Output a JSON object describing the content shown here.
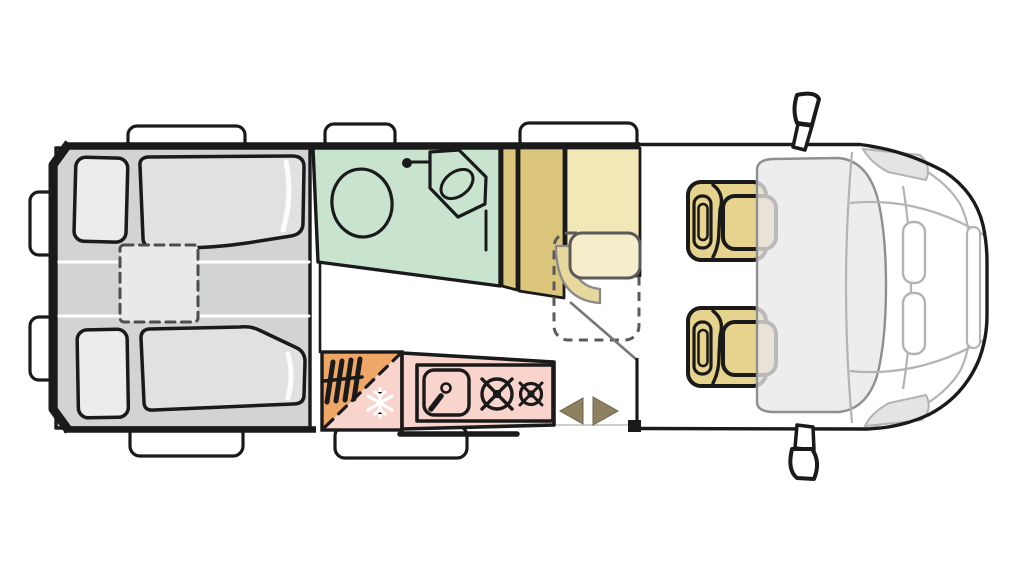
{
  "diagram": {
    "type": "campervan-floorplan-top-view",
    "orientation": "van front (cab) on the right, rear doors on the left",
    "areas": {
      "rear_beds": "two single beds with pillows and a dashed center filler cushion",
      "bathroom": "washroom with toilet and fold-away sink",
      "wardrobe": "tall wardrobe cabinets",
      "dinette": "travel seat with dashed removable table outline",
      "kitchen": "kitchen counter with sink and two gas burners",
      "fridge_heater": "fridge (snowflake symbol) stacked with heater (vent symbol)",
      "entry_door": "sliding door opening marked by two arrows",
      "cab": "driver cab with two swivel seats, dashboard and windscreen"
    },
    "icons": [
      "toilet-icon",
      "folding-sink-icon",
      "door-hinge-icon",
      "snowflake-icon",
      "heater-vent-icon",
      "sink-basin-icon",
      "faucet-icon",
      "burner-large-icon",
      "burner-small-icon",
      "arrow-left-icon",
      "arrow-right-icon",
      "mirror-icon",
      "grille-vent-icon",
      "headlight-icon",
      "window-tab-icon",
      "tail-light-icon"
    ]
  },
  "colors": {
    "outline": "#1a1a1a",
    "floor": "#ffffff",
    "bed_base": "#d2d3d5",
    "mattress": "#e0e1e3",
    "pillow": "#ebecee",
    "highlight": "#ffffff",
    "filler_fill": "#e9e9e9",
    "filler_dash": "#4d4d4d",
    "bathroom": "#c8e4ce",
    "wardrobe": "#dcc67c",
    "wardrobe_light": "#f2e7b6",
    "seat_cushion": "#f6eecb",
    "seat_back": "#e7d89e",
    "seat_back_stroke": "#8a8a8a",
    "cab_seat": "#e6d38d",
    "dashboard_fill": "#e8e8e8",
    "dashboard_stroke": "#8f8f8f",
    "detail_gray": "#b3b3b3",
    "headlight_fill": "#e4e4e4",
    "heater_orange": "#efa767",
    "kitchen_pink": "#f8d4cc",
    "arrow_olive": "#8e8161",
    "arrow_edge": "#6f6347",
    "snowflake": "#ffffff",
    "divider_white": "#ffffff",
    "mid_gray_line": "#777777",
    "light_line": "#cfcfcf",
    "dash_gray": "#5a5a5a"
  }
}
